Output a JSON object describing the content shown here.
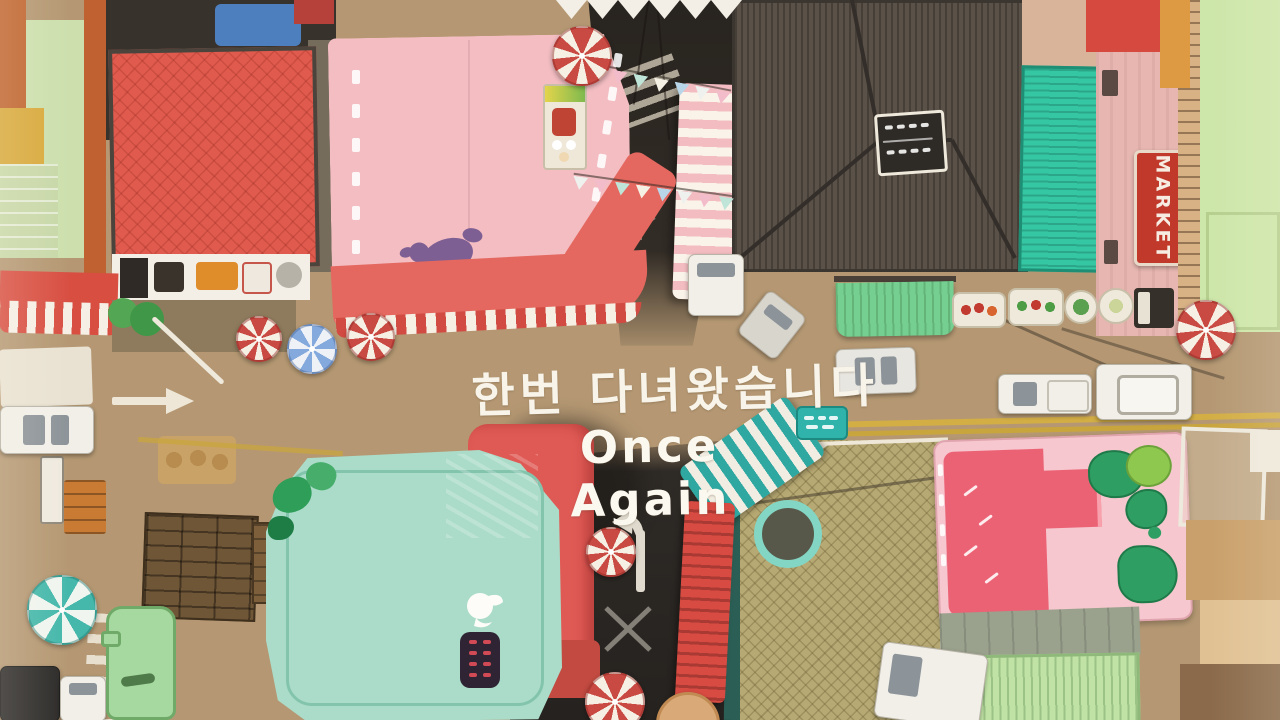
{
  "title_card": {
    "korean_title": "한번 다녀왔습니다",
    "english_title": "Once Again"
  },
  "signs": {
    "market_sign": "MARKET"
  },
  "icons": {
    "umbrella": "candy-umbrella-icon",
    "dog": "poodle-silhouette-icon",
    "bird": "dove-logo-icon",
    "arrow": "road-arrow-icon"
  },
  "colors": {
    "pavement_tan": "#b59873",
    "asphalt_dark": "#2e2a26",
    "roof_red": "#e05a4d",
    "roof_pink": "#f3bdc2",
    "roof_brown": "#5a5148",
    "roof_teal": "#35c6a3",
    "roof_mint": "#abdcc9",
    "roof_olive": "#b7a973",
    "roof_pink_bright": "#f6c7ce",
    "roof_green_light": "#cde6a9",
    "awning_coral": "#e4685f",
    "umbrella_red": "#c94a42",
    "umbrella_blue": "#84a9dc",
    "umbrella_teal": "#45b8ab",
    "market_sign_red": "#c0392b",
    "title_white": "#f8f4ea"
  }
}
